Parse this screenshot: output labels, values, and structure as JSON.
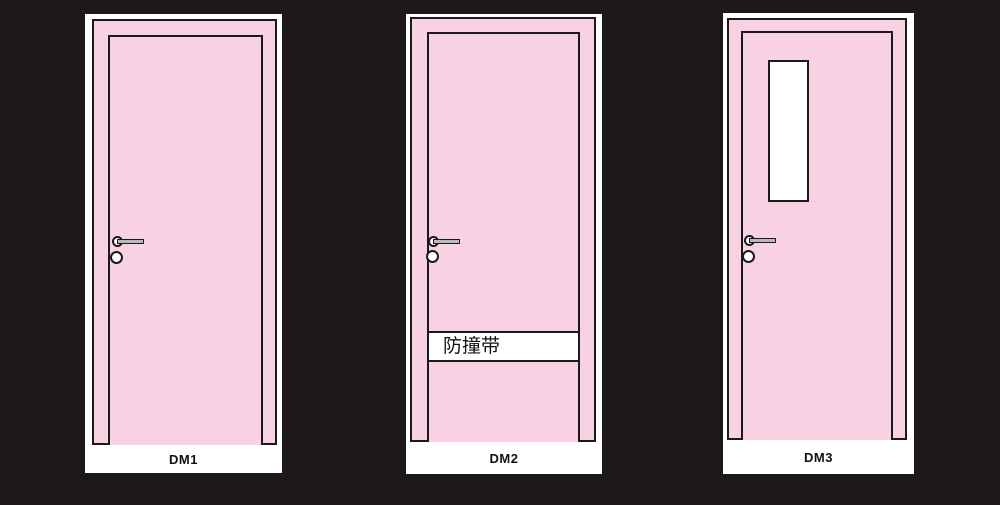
{
  "colors": {
    "background": "#1d191a",
    "door_fill": "#f8d2e2",
    "outline": "#1a1a1a",
    "panel": "#ffffff",
    "handle_bar": "#b9b9b9",
    "label_text": "#111111"
  },
  "doors": [
    {
      "label": "DM1",
      "has_band": false,
      "has_window": false
    },
    {
      "label": "DM2",
      "has_band": true,
      "band_text": "防撞带",
      "has_window": false
    },
    {
      "label": "DM3",
      "has_band": false,
      "has_window": true
    }
  ]
}
